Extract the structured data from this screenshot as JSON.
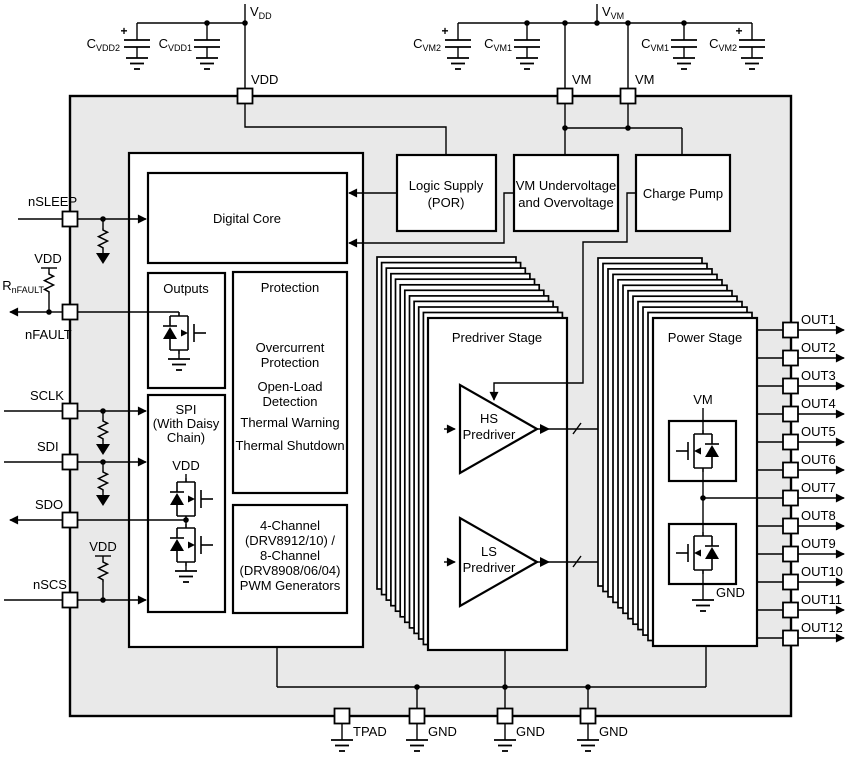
{
  "colors": {
    "chip_fill": "#e9e9e9",
    "line": "#000000",
    "block_fill": "#ffffff"
  },
  "top": {
    "vdd_rail": {
      "main": "V",
      "sub": "DD"
    },
    "cap_vdd2": {
      "main": "C",
      "sub": "VDD2",
      "plus": "+"
    },
    "cap_vdd1": {
      "main": "C",
      "sub": "VDD1"
    },
    "vdd_pin_label": "VDD",
    "vm_rail": {
      "main": "V",
      "sub": "VM"
    },
    "cap_vm2_left": {
      "main": "C",
      "sub": "VM2",
      "plus": "+"
    },
    "cap_vm1_left": {
      "main": "C",
      "sub": "VM1"
    },
    "cap_vm1_right": {
      "main": "C",
      "sub": "VM1"
    },
    "cap_vm2_right": {
      "main": "C",
      "sub": "VM2",
      "plus": "+"
    },
    "vm_pin_label_1": "VM",
    "vm_pin_label_2": "VM"
  },
  "left": {
    "nsleep": "nSLEEP",
    "nfault": "nFAULT",
    "sclk": "SCLK",
    "sdi": "SDI",
    "sdo": "SDO",
    "nscs": "nSCS",
    "vdd_pullup_nfault": "VDD",
    "r_nfault": {
      "main": "R",
      "sub": "nFAULT"
    },
    "vdd_pullup_nscs": "VDD"
  },
  "blocks": {
    "digital_core": "Digital Core",
    "logic_supply_1": "Logic Supply",
    "logic_supply_2": "(POR)",
    "vm_monitor_1": "VM Undervoltage",
    "vm_monitor_2": "and Overvoltage",
    "charge_pump": "Charge Pump",
    "outputs": "Outputs",
    "protection_title": "Protection",
    "protection_items": [
      {
        "l1": "Overcurrent",
        "l2": "Protection"
      },
      {
        "l1": "Open-Load",
        "l2": "Detection"
      },
      {
        "l1": "Thermal Warning"
      },
      {
        "l1": "Thermal Shutdown"
      }
    ],
    "spi_1": "SPI",
    "spi_2": "(With Daisy",
    "spi_3": "Chain)",
    "spi_vdd": "VDD",
    "pwm_1": "4-Channel",
    "pwm_2": "(DRV8912/10) /",
    "pwm_3": "8-Channel",
    "pwm_4": "(DRV8908/06/04)",
    "pwm_5": "PWM Generators",
    "predriver_title": "Predriver Stage",
    "hs_1": "HS",
    "hs_2": "Predriver",
    "ls_1": "LS",
    "ls_2": "Predriver",
    "power_title": "Power Stage",
    "power_vm": "VM",
    "power_gnd": "GND"
  },
  "right_pins": [
    "OUT1",
    "OUT2",
    "OUT3",
    "OUT4",
    "OUT5",
    "OUT6",
    "OUT7",
    "OUT8",
    "OUT9",
    "OUT10",
    "OUT11",
    "OUT12"
  ],
  "bottom_pins": [
    "TPAD",
    "GND",
    "GND",
    "GND"
  ]
}
